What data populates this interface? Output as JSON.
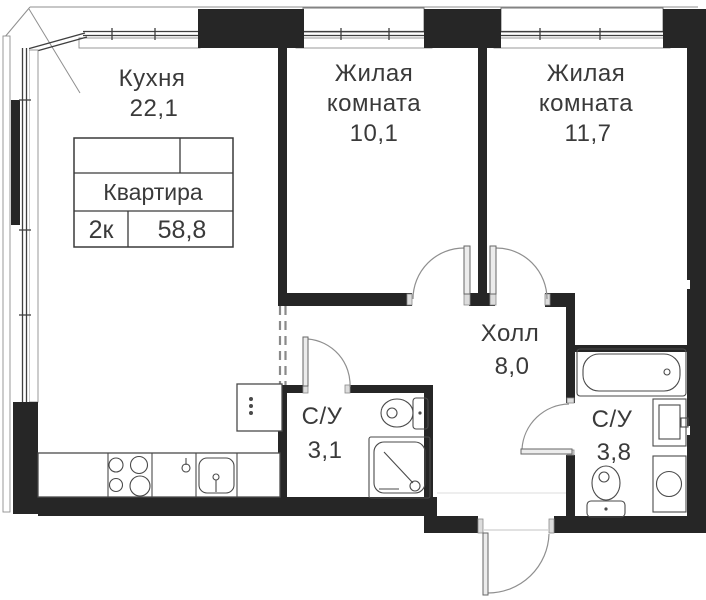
{
  "floorplan": {
    "type": "apartment-plan",
    "title_block": {
      "label": "Квартира",
      "rooms_count": "2к",
      "total_area": "58,8"
    },
    "rooms": {
      "kitchen": {
        "name": "Кухня",
        "area": "22,1"
      },
      "living1": {
        "name_line1": "Жилая",
        "name_line2": "комната",
        "area": "10,1"
      },
      "living2": {
        "name_line1": "Жилая",
        "name_line2": "комната",
        "area": "11,7"
      },
      "hall": {
        "name": "Холл",
        "area": "8,0"
      },
      "bath_small": {
        "name": "С/У",
        "area": "3,1"
      },
      "bath_big": {
        "name": "С/У",
        "area": "3,8"
      }
    },
    "colors": {
      "wall": "#262626",
      "line": "#4a4a4a",
      "door": "#8f8f8f",
      "text": "#3a3a3a",
      "background": "#ffffff"
    }
  }
}
